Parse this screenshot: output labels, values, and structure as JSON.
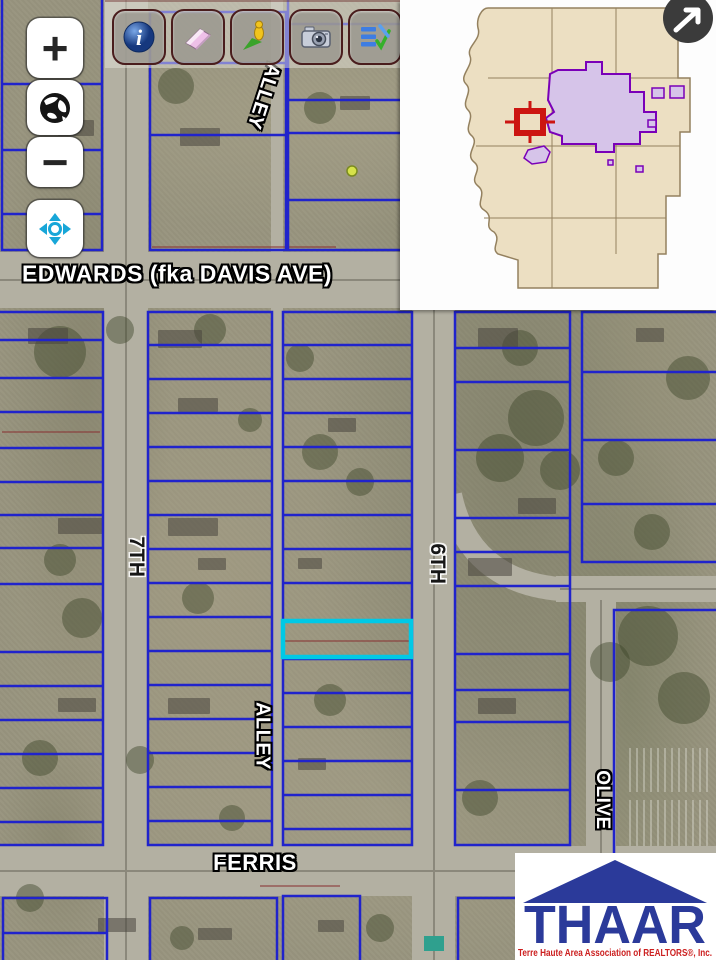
{
  "app": {
    "name": "Parcel Map Viewer"
  },
  "colors": {
    "parcel_line": "#2023cc",
    "highlight": "#00c9e6",
    "street_fill": "#b3b0a2",
    "street_center": "#8b887b",
    "aerial_base": "#98947e",
    "maroon_line": "#8a3535",
    "inset_county_fill": "#ecdfc2",
    "inset_county_line": "#94815f",
    "inset_city_fill": "#d6c4e9",
    "inset_city_stroke": "#7a00b8",
    "inset_marker": "#cc1511",
    "logo_blue": "#2b3a9a",
    "logo_red": "#cc2020"
  },
  "controls": {
    "zoom_in_label": "+",
    "zoom_out_label": "−",
    "globe_tool": "globe",
    "pan_tool": "pan"
  },
  "toolbar": {
    "icons": [
      {
        "name": "info"
      },
      {
        "name": "eraser"
      },
      {
        "name": "marker"
      },
      {
        "name": "camera"
      },
      {
        "name": "report"
      },
      {
        "name": "help"
      }
    ]
  },
  "overview_map": {
    "toggle_arrow": "northeast-arrow",
    "marker": "red-extent-square",
    "city_area": "purple-polygon"
  },
  "map": {
    "street_labels": [
      {
        "text": "EDWARDS (fka DAVIS AVE)",
        "x": 177,
        "y": 274,
        "rot": 0,
        "style": "light",
        "size": 23
      },
      {
        "text": "ALLEY",
        "x": 263,
        "y": 96,
        "rot": 108,
        "style": "light",
        "size": 20
      },
      {
        "text": "7TH",
        "x": 136,
        "y": 557,
        "rot": 90,
        "style": "dark",
        "size": 21
      },
      {
        "text": "6TH",
        "x": 437,
        "y": 564,
        "rot": 90,
        "style": "dark",
        "size": 21
      },
      {
        "text": "ALLEY",
        "x": 262,
        "y": 736,
        "rot": 90,
        "style": "light",
        "size": 20
      },
      {
        "text": "OLIVE",
        "x": 602,
        "y": 800,
        "rot": 90,
        "style": "light",
        "size": 19
      },
      {
        "text": "FERRIS",
        "x": 255,
        "y": 863,
        "rot": 0,
        "style": "light",
        "size": 22
      }
    ],
    "streets": [
      {
        "name": "edwards",
        "x": 0,
        "y": 252,
        "w": 716,
        "h": 56
      },
      {
        "name": "ferris",
        "x": 0,
        "y": 846,
        "w": 716,
        "h": 50
      },
      {
        "name": "7th",
        "x": 104,
        "y": 0,
        "w": 44,
        "h": 960
      },
      {
        "name": "6th",
        "x": 412,
        "y": 0,
        "w": 43,
        "h": 960
      },
      {
        "name": "olive",
        "x": 586,
        "y": 592,
        "w": 30,
        "h": 368
      },
      {
        "name": "east-road",
        "x": 556,
        "y": 576,
        "w": 160,
        "h": 26
      },
      {
        "name": "alley-n",
        "x": 271,
        "y": 0,
        "w": 12,
        "h": 252
      },
      {
        "name": "alley-s",
        "x": 271,
        "y": 308,
        "w": 12,
        "h": 540
      }
    ],
    "center_lines": [
      [
        126,
        0,
        126,
        960
      ],
      [
        434,
        310,
        434,
        960
      ],
      [
        0,
        280,
        716,
        280
      ],
      [
        0,
        871,
        716,
        871
      ],
      [
        601,
        600,
        601,
        960
      ],
      [
        560,
        589,
        716,
        589
      ]
    ],
    "curved_roads": [
      {
        "d": "M450,495 C462,552 500,584 560,589"
      }
    ],
    "blocks": [
      {
        "x": 2,
        "y": -6,
        "w": 100,
        "h": 256,
        "rows": [
          90,
          156,
          220
        ]
      },
      {
        "x": 150,
        "y": 12,
        "w": 136,
        "h": 238,
        "rows": [
          51,
          123
        ]
      },
      {
        "x": 288,
        "y": -6,
        "w": 114,
        "h": 256,
        "rows": [
          30,
          106,
          139,
          206
        ]
      },
      {
        "x": -8,
        "y": 312,
        "w": 111,
        "h": 533,
        "rows": [
          28,
          66,
          100,
          136,
          170,
          203,
          236,
          272,
          340,
          374,
          408,
          442,
          476,
          510
        ]
      },
      {
        "x": 148,
        "y": 312,
        "w": 124,
        "h": 533,
        "rows": [
          33,
          67,
          101,
          135,
          169,
          203,
          237,
          271,
          305,
          339,
          373,
          407,
          441,
          475,
          509
        ]
      },
      {
        "x": 283,
        "y": 312,
        "w": 129,
        "h": 533,
        "rows": [
          33,
          67,
          101,
          135,
          169,
          203,
          237,
          271,
          347,
          381,
          415,
          449,
          483,
          517
        ]
      },
      {
        "x": 455,
        "y": 312,
        "w": 115,
        "h": 533,
        "rows": [
          36,
          70,
          138,
          206,
          240,
          274,
          342,
          378,
          410,
          478
        ]
      },
      {
        "x": 582,
        "y": 312,
        "w": 138,
        "h": 250,
        "rows": [
          60,
          128,
          192
        ]
      },
      {
        "x": 614,
        "y": 610,
        "w": 130,
        "h": 352,
        "rows": []
      },
      {
        "x": 3,
        "y": 898,
        "w": 104,
        "h": 66,
        "rows": [
          35
        ]
      },
      {
        "x": 150,
        "y": 898,
        "w": 127,
        "h": 66,
        "rows": []
      },
      {
        "x": 283,
        "y": 896,
        "w": 77,
        "h": 68,
        "rows": []
      },
      {
        "x": 458,
        "y": 898,
        "w": 60,
        "h": 66,
        "rows": []
      }
    ],
    "maroon_lines": [
      [
        285,
        641,
        410,
        641
      ],
      [
        2,
        432,
        100,
        432
      ],
      [
        152,
        247,
        336,
        247
      ],
      [
        260,
        886,
        340,
        886
      ]
    ],
    "highlight_parcel": {
      "x": 283,
      "y": 621,
      "w": 128,
      "h": 36
    }
  },
  "logo": {
    "title": "THAAR",
    "tagline": "Terre Haute Area Association of REALTORS®, Inc."
  }
}
